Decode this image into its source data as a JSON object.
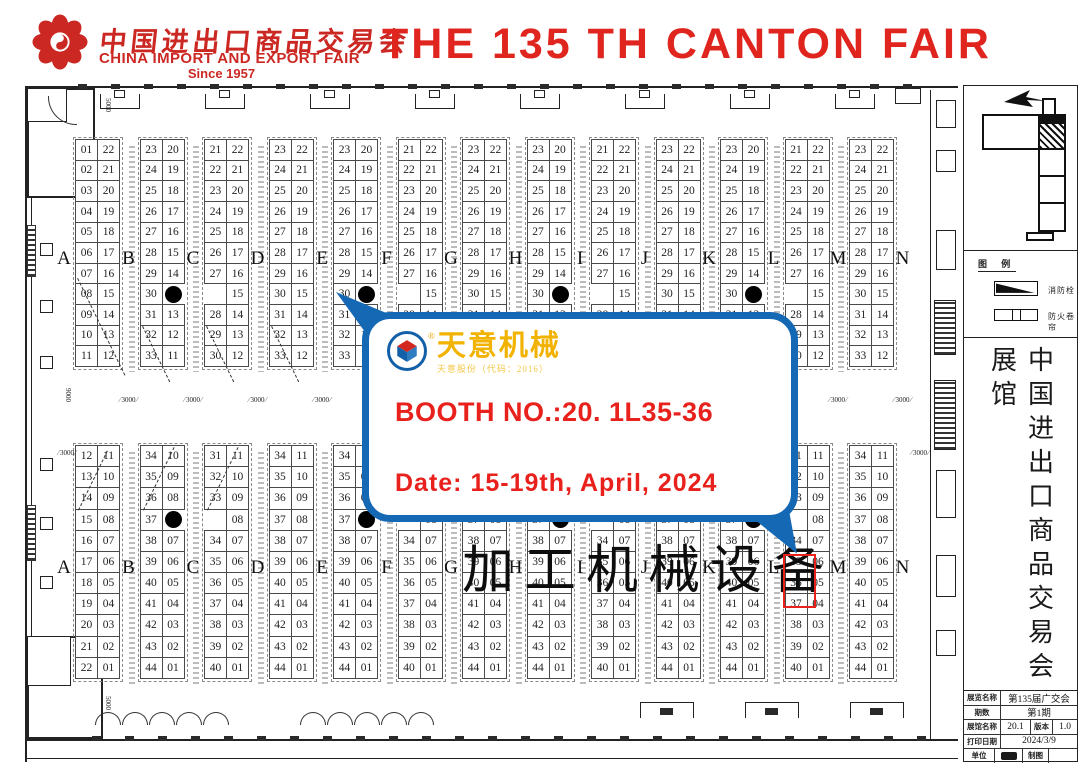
{
  "header": {
    "logo_cn": "中国进出口商品交易会",
    "logo_en": "CHINA IMPORT AND EXPORT FAIR",
    "logo_since": "Since 1957",
    "title": "THE 135 TH CANTON FAIR"
  },
  "plan": {
    "letters": [
      "A",
      "B",
      "C",
      "D",
      "E",
      "F",
      "G",
      "H",
      "I",
      "J",
      "K",
      "L",
      "M",
      "N"
    ],
    "center_label": "加工机械设备",
    "sequence": [
      "A",
      "B",
      "C",
      "D",
      "B",
      "C",
      "D",
      "B",
      "C",
      "D",
      "B",
      "C",
      "D"
    ],
    "booth_types": {
      "top": {
        "A": {
          "left": [
            "01",
            "02",
            "03",
            "04",
            "05",
            "06",
            "07",
            "08",
            "09",
            "10",
            "11"
          ],
          "right": [
            "22",
            "21",
            "20",
            "19",
            "18",
            "17",
            "16",
            "15",
            "14",
            "13",
            "12"
          ]
        },
        "B": {
          "left": [
            "23",
            "24",
            "25",
            "26",
            "27",
            "28",
            "29",
            "30",
            "31",
            "32",
            "33"
          ],
          "right": [
            "20",
            "19",
            "18",
            "17",
            "16",
            "15",
            "14",
            "DOT",
            "13",
            "12",
            "11"
          ]
        },
        "C": {
          "left": [
            "21",
            "22",
            "23",
            "24",
            "25",
            "26",
            "27",
            "",
            "28",
            "29",
            "30"
          ],
          "right": [
            "22",
            "21",
            "20",
            "19",
            "18",
            "17",
            "16",
            "15",
            "14",
            "13",
            "12"
          ]
        },
        "D": {
          "left": [
            "23",
            "24",
            "25",
            "26",
            "27",
            "28",
            "29",
            "30",
            "31",
            "32",
            "33"
          ],
          "right": [
            "22",
            "21",
            "20",
            "19",
            "18",
            "17",
            "16",
            "15",
            "14",
            "13",
            "12"
          ]
        }
      },
      "bottom": {
        "A": {
          "left": [
            "12",
            "13",
            "14",
            "15",
            "16",
            "17",
            "18",
            "19",
            "20",
            "21",
            "22"
          ],
          "right": [
            "11",
            "10",
            "09",
            "08",
            "07",
            "06",
            "05",
            "04",
            "03",
            "02",
            "01"
          ]
        },
        "B": {
          "left": [
            "34",
            "35",
            "36",
            "37",
            "38",
            "39",
            "40",
            "41",
            "42",
            "43",
            "44"
          ],
          "right": [
            "10",
            "09",
            "08",
            "DOT",
            "07",
            "06",
            "05",
            "04",
            "03",
            "02",
            "01"
          ]
        },
        "C": {
          "left": [
            "31",
            "32",
            "33",
            "",
            "34",
            "35",
            "36",
            "37",
            "38",
            "39",
            "40"
          ],
          "right": [
            "11",
            "10",
            "09",
            "08",
            "07",
            "06",
            "05",
            "04",
            "03",
            "02",
            "01"
          ]
        },
        "D": {
          "left": [
            "34",
            "35",
            "36",
            "37",
            "38",
            "39",
            "40",
            "41",
            "42",
            "43",
            "44"
          ],
          "right": [
            "11",
            "10",
            "09",
            "08",
            "07",
            "06",
            "05",
            "04",
            "03",
            "02",
            "01"
          ]
        }
      }
    },
    "highlight": {
      "hall": "20.1",
      "row_letter": "L",
      "booths": [
        "35",
        "36"
      ],
      "half": "bottom",
      "pair_index": 11,
      "row_start": 5,
      "row_count": 2,
      "color": "#e8211d"
    },
    "dimensions": {
      "corridor": "3000",
      "left_height": "9000",
      "wall_span": "5000"
    }
  },
  "bubble": {
    "company": "天意机械",
    "company_sub": "天意股份（代码：2016）",
    "booth_line": "BOOTH NO.:20. 1L35-36",
    "date_line": "Date: 15-19th, April, 2024",
    "accent_color": "#1568b3",
    "text_color": "#e8211d"
  },
  "sidebar": {
    "legend": {
      "title": "图 例",
      "items": [
        {
          "icon": "ramp-symbol",
          "label": "消防栓"
        },
        {
          "icon": "fire-shutter-symbol",
          "label": "防火卷帘"
        }
      ]
    },
    "vertical_title": "中国进出口商品交易会展馆",
    "titleblock": {
      "exhibition_label": "展览名称",
      "exhibition_value": "第135届广交会",
      "phase_label": "期数",
      "phase_value": "第1期",
      "hall_label": "展馆名称",
      "hall_value": "20.1",
      "version_label": "版本",
      "version_value": "1.0",
      "print_label": "打印日期",
      "print_value": "2024/3/9",
      "unit_label": "单位",
      "draw_label": "制图"
    }
  }
}
